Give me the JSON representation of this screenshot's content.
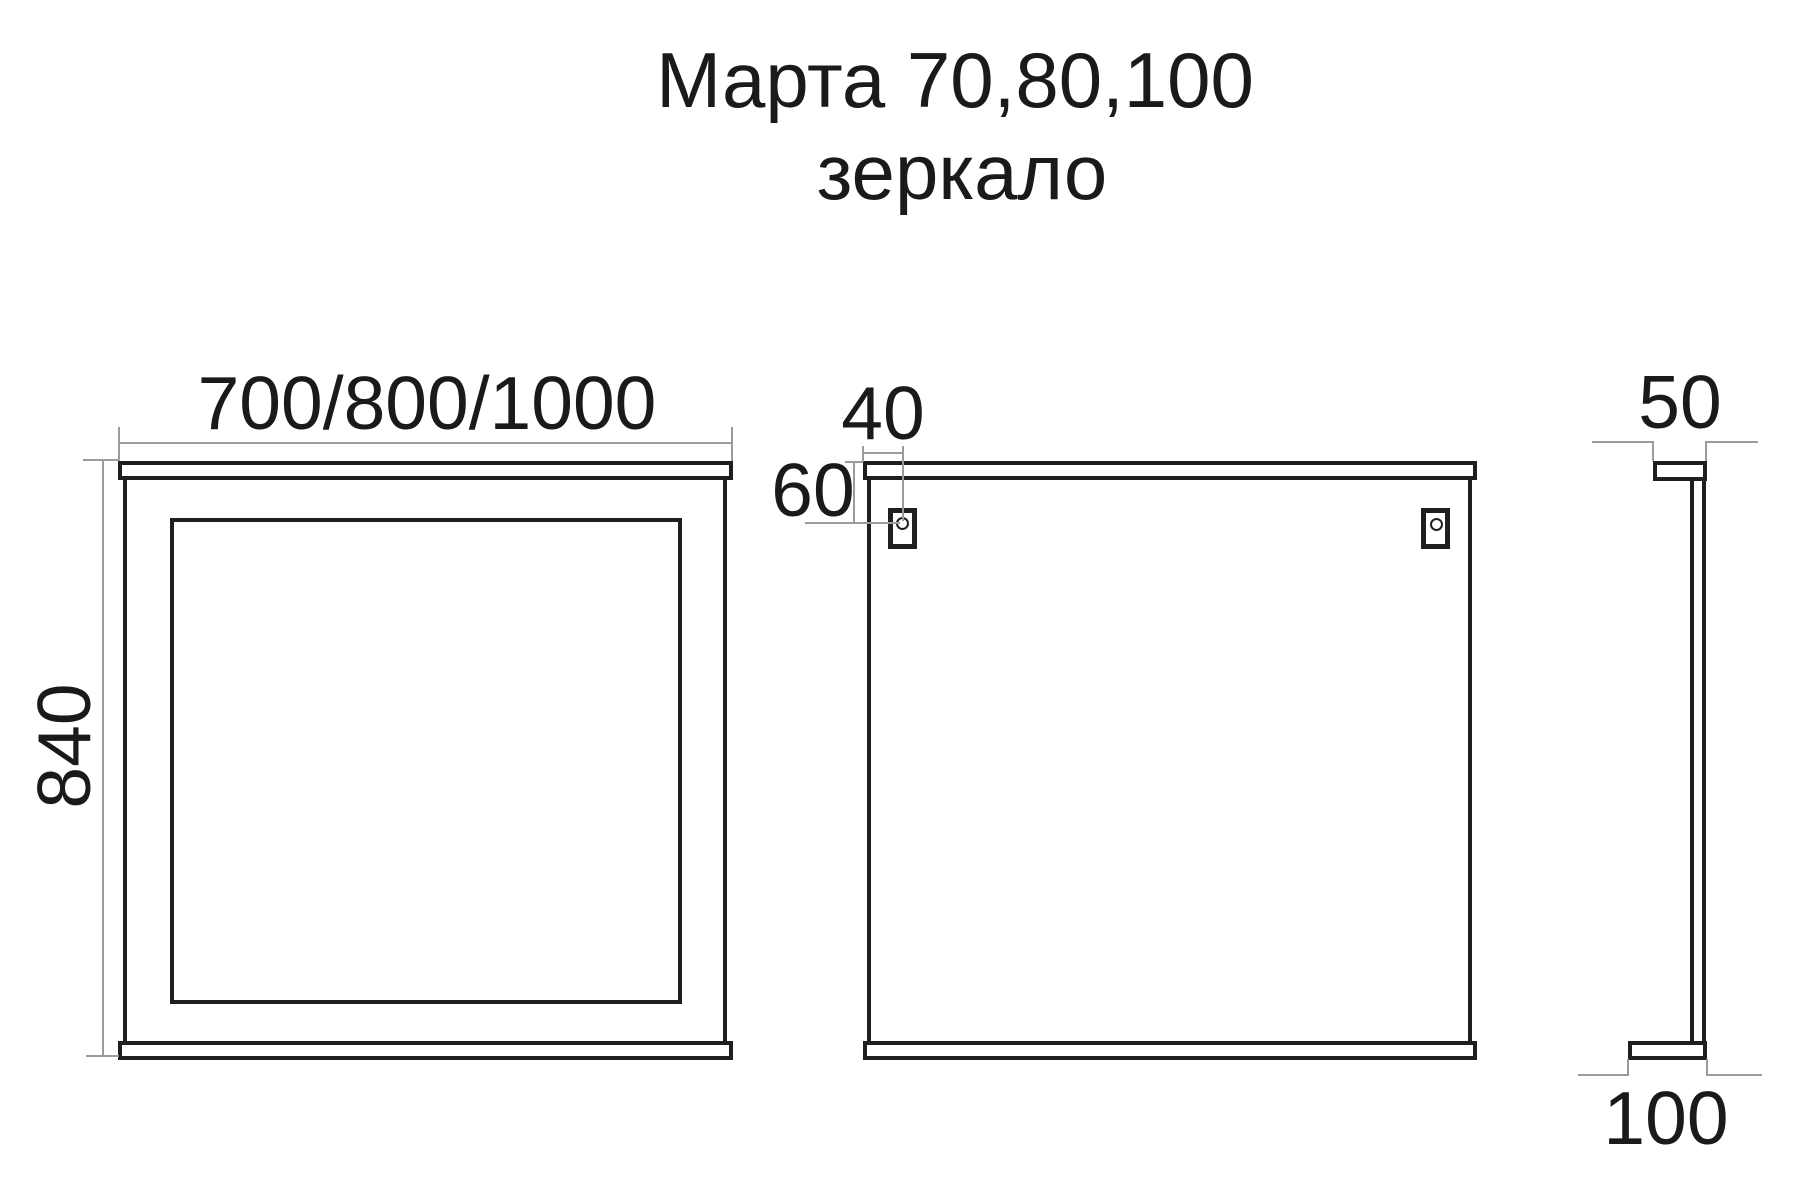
{
  "title": {
    "line1": "Марта 70,80,100",
    "line2": "зеркало"
  },
  "dimensions": {
    "front_width": "700/800/1000",
    "front_height": "840",
    "bracket_offset_horizontal": "40",
    "bracket_offset_vertical": "60",
    "side_top_depth": "50",
    "side_bottom_depth": "100"
  },
  "colors": {
    "outline": "#1f1f1f",
    "dimension_line": "#9b9b9b",
    "text": "#1a1a1a",
    "background": "#ffffff"
  }
}
